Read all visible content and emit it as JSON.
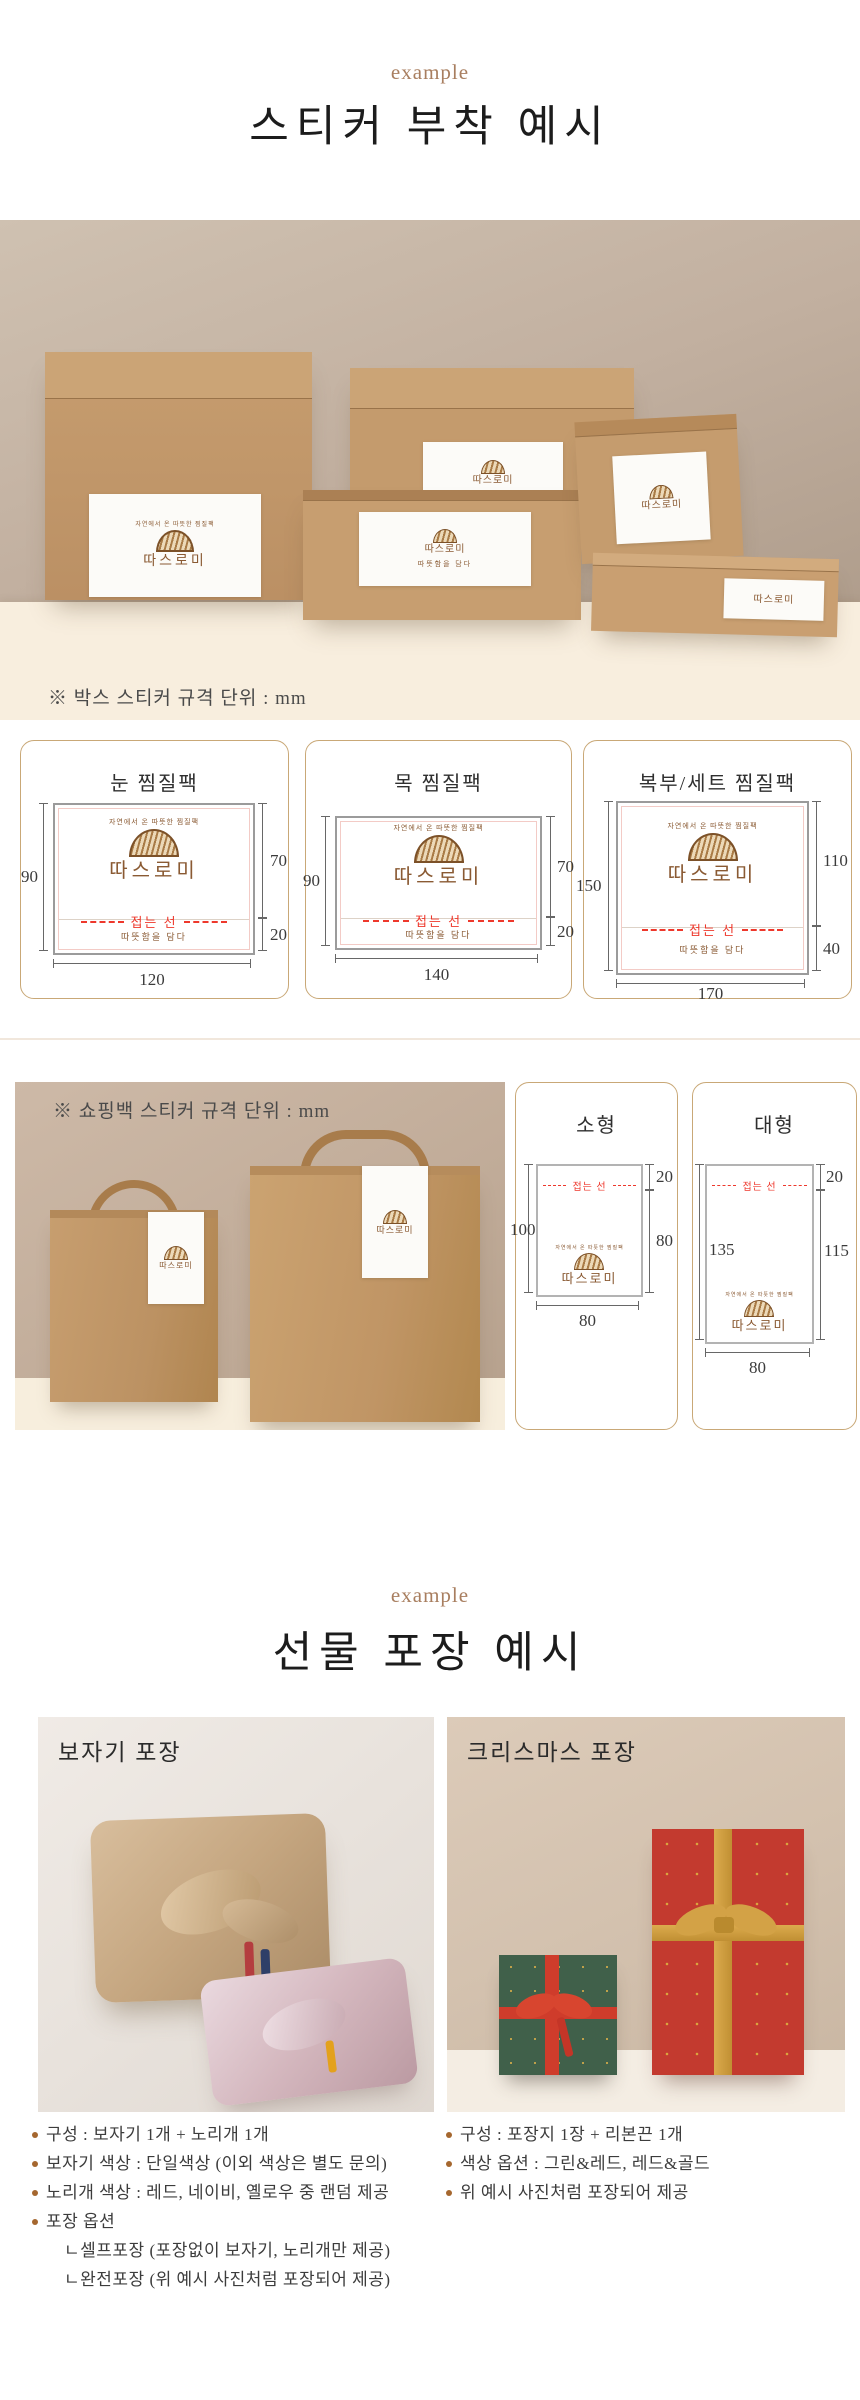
{
  "colors": {
    "accent_brown": "#a87e5f",
    "brand_brown": "#8a5a33",
    "fold_red": "#ee382c",
    "kraft": "#c49a6c",
    "card_border": "#c9a877"
  },
  "brand": {
    "arch": "자연에서 온 따뜻한 찜질팩",
    "name": "따스로미",
    "tagline": "따뜻함을 담다",
    "fold": "접는 선"
  },
  "section_sticker": {
    "eyebrow": "example",
    "title": "스티커 부착 예시",
    "box_note": "※ 박스 스티커 규격 단위 : mm",
    "bag_note": "※ 쇼핑백 스티커 규격 단위 : mm"
  },
  "box_cards": [
    {
      "title": "눈 찜질팩",
      "w": "120",
      "h": "90",
      "upper": "70",
      "lower": "20"
    },
    {
      "title": "목 찜질팩",
      "w": "140",
      "h": "90",
      "upper": "70",
      "lower": "20"
    },
    {
      "title": "복부/세트 찜질팩",
      "w": "170",
      "h": "150",
      "upper": "110",
      "lower": "40"
    }
  ],
  "bag_cards": [
    {
      "title": "소형",
      "h": "100",
      "top": "20",
      "lower": "80",
      "w": "80"
    },
    {
      "title": "대형",
      "h": "135",
      "top": "20",
      "lower": "115",
      "w": "80"
    }
  ],
  "section_gift": {
    "eyebrow": "example",
    "title": "선물 포장 예시",
    "left_label": "보자기 포장",
    "right_label": "크리스마스 포장",
    "left_bullets": [
      {
        "text": "구성 : 보자기 1개 + 노리개 1개"
      },
      {
        "text": "보자기 색상 : 단일색상 (이외 색상은 별도 문의)"
      },
      {
        "text": "노리개 색상 : 레드, 네이비, 옐로우 중 랜덤 제공"
      },
      {
        "text": "포장 옵션"
      },
      {
        "text": "ㄴ셀프포장 (포장없이 보자기, 노리개만 제공)"
      },
      {
        "text": "ㄴ완전포장 (위 예시 사진처럼 포장되어 제공)"
      }
    ],
    "right_bullets": [
      {
        "text": "구성 : 포장지 1장 + 리본끈 1개"
      },
      {
        "text": "색상 옵션 : 그린&레드, 레드&골드"
      },
      {
        "text": "위 예시 사진처럼 포장되어 제공"
      }
    ]
  }
}
